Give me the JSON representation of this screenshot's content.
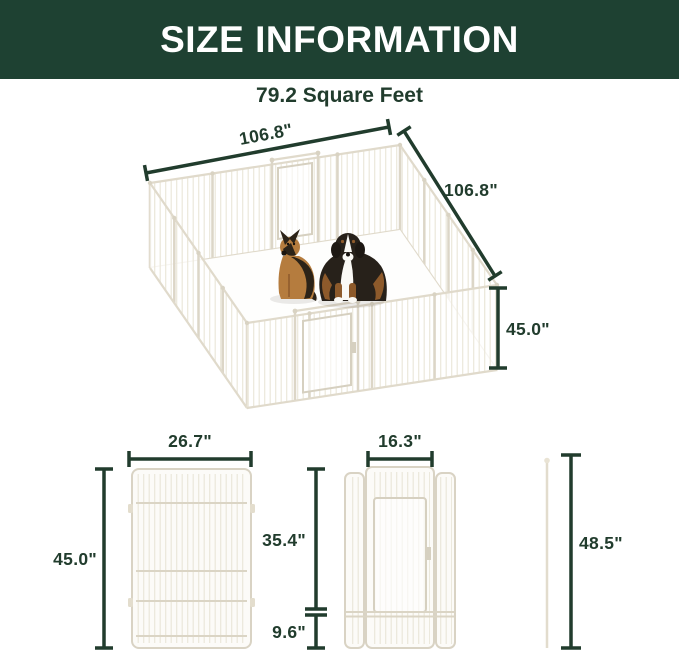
{
  "header": {
    "title": "SIZE INFORMATION"
  },
  "subtitle": "79.2 Square Feet",
  "main_diagram": {
    "top_width_label": "106.8\"",
    "depth_label": "106.8\"",
    "height_label": "45.0\"",
    "contents": {
      "dog_left": "german-shepherd",
      "dog_right": "bernese-mountain-dog",
      "enclosure": "white-metal-playpen-16-panels"
    }
  },
  "panel_diagram": {
    "width_label": "26.7\"",
    "height_label": "45.0\""
  },
  "door_panel_diagram": {
    "door_width_label": "16.3\"",
    "upper_height_label": "35.4\"",
    "lower_height_label": "9.6\""
  },
  "rod_diagram": {
    "height_label": "48.5\""
  },
  "colors": {
    "header_bg": "#1e4132",
    "header_text": "#ffffff",
    "dimension": "#213c2d",
    "pen_frame": "#dcd6c7",
    "pen_wire": "#ebe7da",
    "dog_tan": "#b57c3e",
    "dog_dark": "#2c2318",
    "dog_brown": "#8d5a2b"
  }
}
